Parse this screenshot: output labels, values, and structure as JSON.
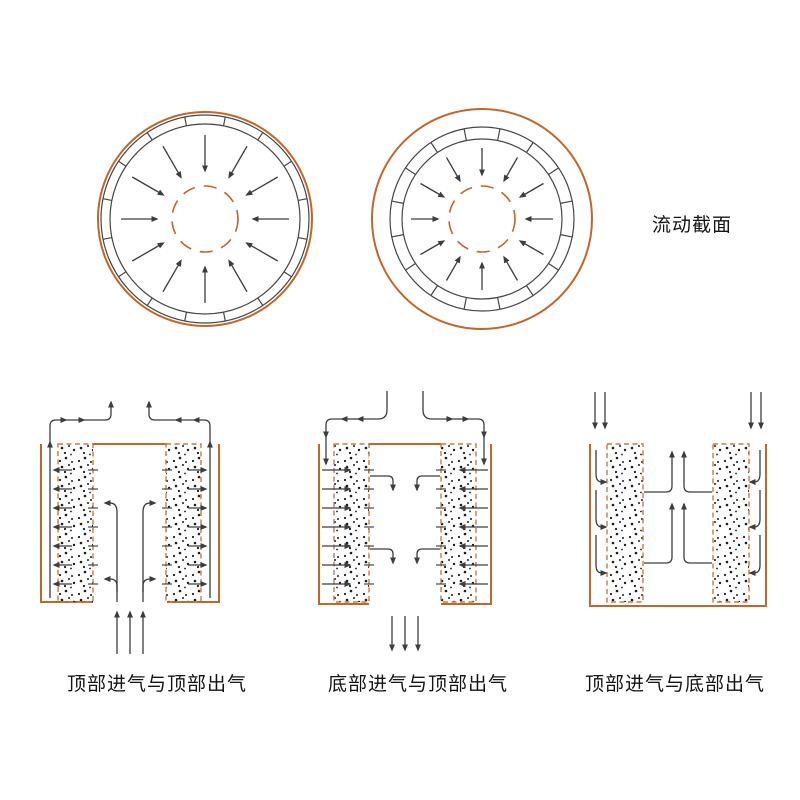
{
  "figure": {
    "section_label": "流动截面",
    "captions": [
      {
        "label": "顶部进气与顶部出气"
      },
      {
        "label": "底部进气与顶部出气"
      },
      {
        "label": "顶部进气与底部出气"
      }
    ]
  },
  "colors": {
    "orange": "#C2662A",
    "orange_dashed": "#CC7A3D",
    "line_gray": "#474747",
    "arrow_gray": "#3d3d3d",
    "dot_black": "#1c1c1c",
    "text": "#141414",
    "background": "#ffffff"
  }
}
